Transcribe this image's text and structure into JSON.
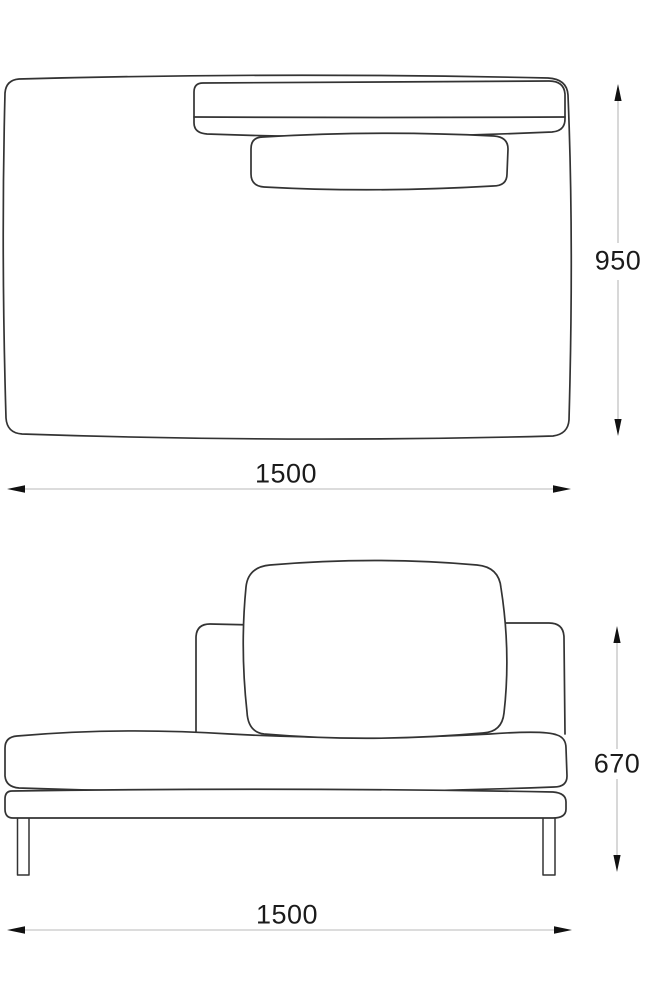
{
  "drawing": {
    "top_view": {
      "depth_dim_label": "950",
      "width_dim_label": "1500"
    },
    "front_view": {
      "height_dim_label": "670",
      "width_dim_label": "1500"
    }
  },
  "colors": {
    "outline": "#333333",
    "dimension_line": "#b8b8b8",
    "arrow": "#111111",
    "label_text": "#1b1b1b",
    "background": "#ffffff"
  }
}
